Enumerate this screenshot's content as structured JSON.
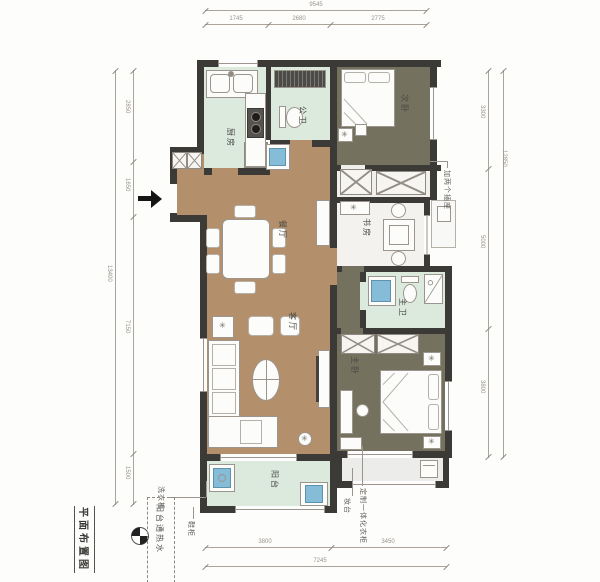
{
  "title": {
    "text": "平面布置图"
  },
  "rooms": {
    "kitchen": {
      "label": "厨房"
    },
    "bath_public": {
      "label": "公卫"
    },
    "bedroom_second": {
      "label": "次卧"
    },
    "study": {
      "label": "书房"
    },
    "bath_master": {
      "label": "主卫"
    },
    "bedroom_master": {
      "label": "主卧"
    },
    "dining": {
      "label": "餐厅"
    },
    "living": {
      "label": "客厅"
    },
    "balcony": {
      "label": "阳台"
    }
  },
  "annotations": {
    "sockets": {
      "label": "加两个插座"
    },
    "washer": {
      "label": "洗衣机"
    },
    "shoe_cabinet": {
      "label": "鞋柜"
    },
    "balcony_hot_water": {
      "label": "阳台通热水"
    },
    "dresser": {
      "label": "妆台"
    },
    "wardrobe": {
      "label": "定制一体化衣柜"
    }
  },
  "dimensions": {
    "top_outer": "9545",
    "top_inner": [
      "1745",
      "2680",
      "2775"
    ],
    "left_outer": "13400",
    "left_inner": [
      "2850",
      "1650",
      "7150",
      "1500"
    ],
    "right_outer": "12850",
    "right_inner": [
      "3300",
      "5000",
      "3800"
    ],
    "bottom_inner": [
      "3800",
      "3450"
    ],
    "bottom_outer": "7245"
  },
  "colors": {
    "wall": "#3b3a37",
    "floor_living": "#b3906b",
    "floor_wet": "#dce9dd",
    "floor_bedroom": "#74715f",
    "floor_study": "#f3f2ee",
    "fixture_blue": "#85bcd8",
    "dimension_line": "#a8a29a"
  }
}
